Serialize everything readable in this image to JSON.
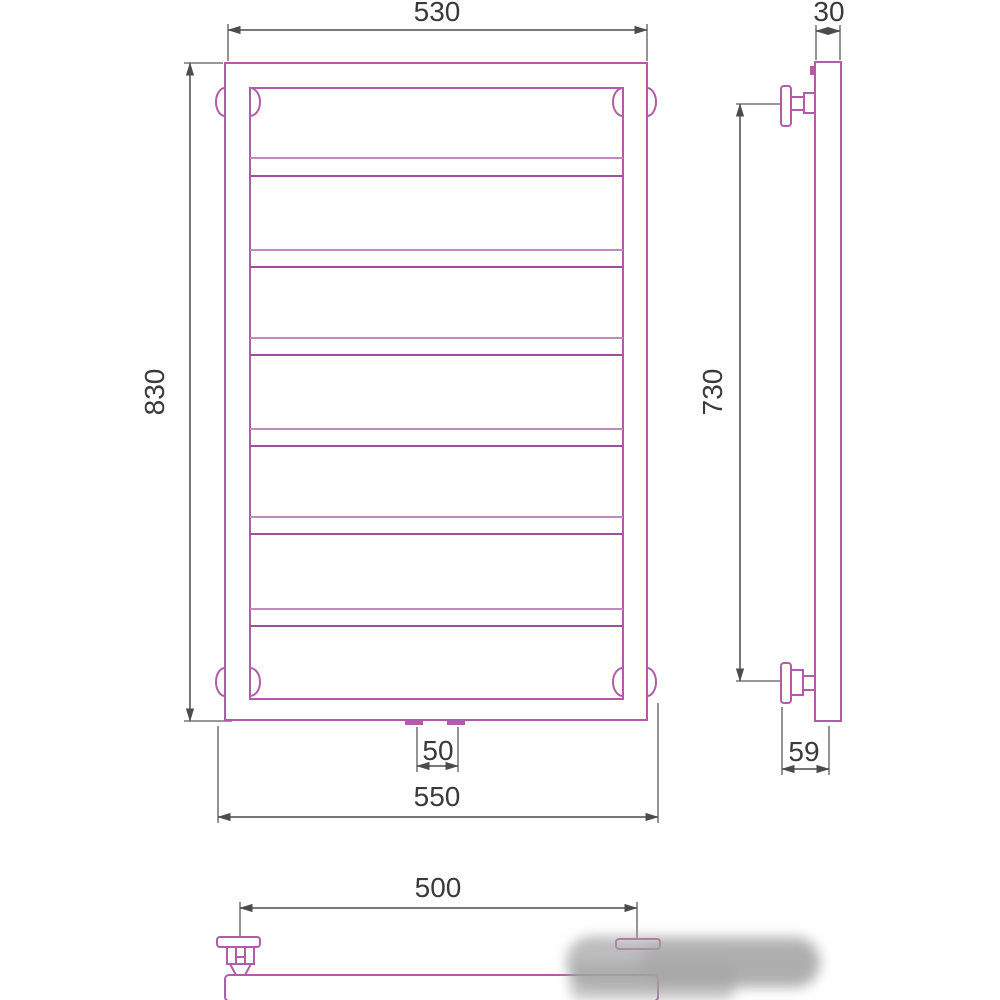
{
  "drawing": {
    "subject": "ladder-towel-rail-technical-drawing",
    "views": [
      "front-view",
      "side-view",
      "bottom-view"
    ]
  },
  "dimensions": {
    "front": {
      "top_width": "530",
      "height": "830",
      "overall_width": "550",
      "connection_spacing": "50"
    },
    "side": {
      "depth": "30",
      "mounting_height": "730",
      "wall_offset": "59"
    },
    "bottom": {
      "bracket_spacing": "500"
    }
  },
  "colors": {
    "outline": "#b05ca6",
    "dimension_line": "#4c4c4c",
    "text": "#3a3a3a",
    "watermark": "#a3a3a3",
    "background": "#ffffff"
  }
}
